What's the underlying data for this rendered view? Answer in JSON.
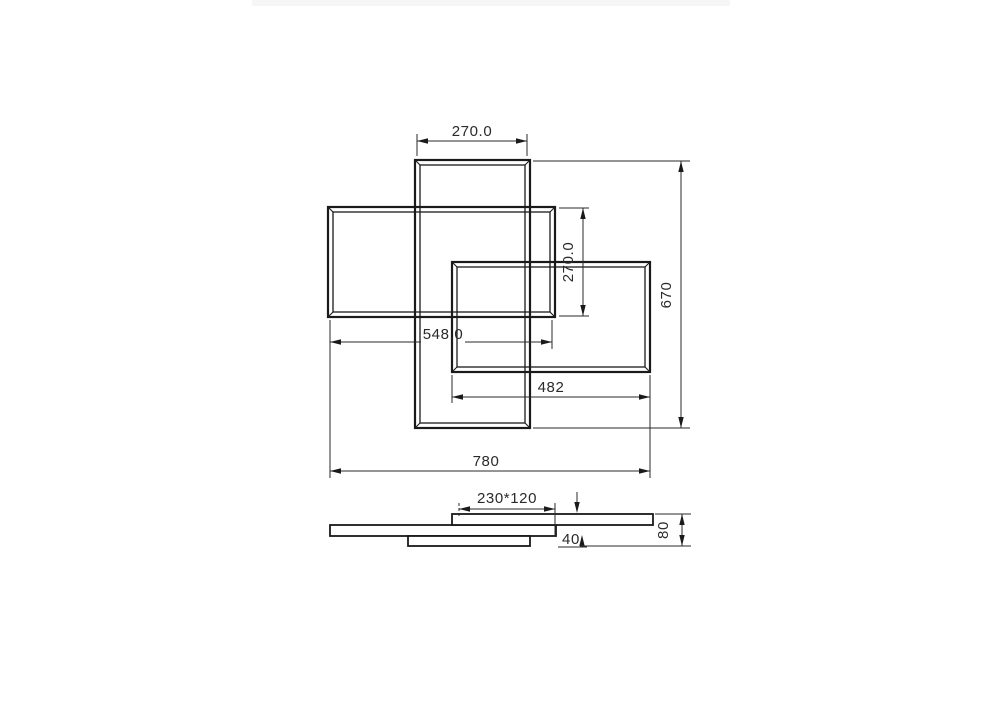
{
  "drawing": {
    "background": "#ffffff",
    "line_color": "#1a1a1a",
    "text_color": "#2a2a2a",
    "top_view": {
      "dim_frame_top_width": "270.0",
      "dim_frame_side_height": "270.0",
      "dim_overall_height": "670",
      "dim_left_frame_width": "548.0",
      "dim_right_frame_width": "482",
      "dim_overall_width": "780"
    },
    "side_view": {
      "dim_canopy_size": "230*120",
      "dim_frame_thickness": "40",
      "dim_overall_height": "80"
    }
  }
}
